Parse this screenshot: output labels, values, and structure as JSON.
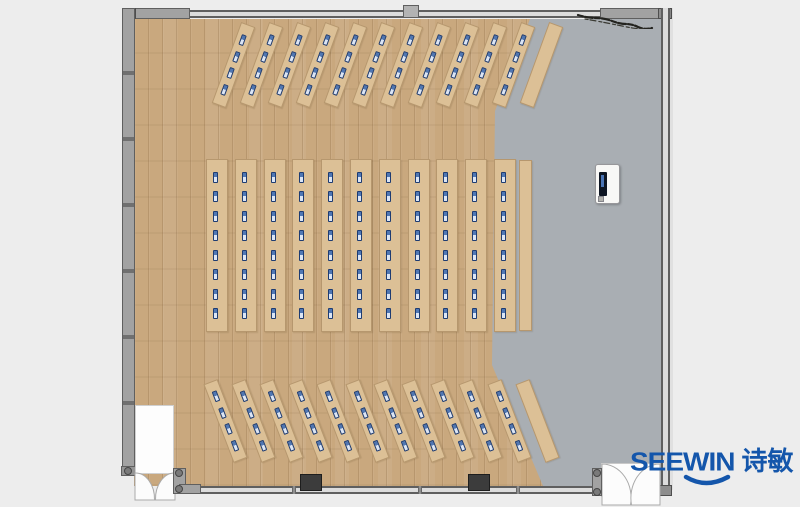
{
  "branding": {
    "logo_text": "SEEWIN",
    "logo_cjk": "诗敏"
  },
  "palette": {
    "page_bg": "#ededed",
    "wood_floor": "#c9a87e",
    "gray_floor": "#a9aeb3",
    "wall_fill": "#a2a2a2",
    "wall_dark": "#5f5f5f",
    "wall_light": "#dcdcdc",
    "desk_fill": "#dcc096",
    "monitor_navy": "#1e3c72",
    "monitor_light": "#dbe5f5",
    "pillar_dark": "#3c3c3c",
    "brand_blue": "#1456ab"
  },
  "floorplan": {
    "description": "Training room / lecture hall plan: fan arrangement of long desks with monitors on wood floor, open gray floor presentation area on right with podium",
    "desk_sections": [
      {
        "name": "top-angled-rows",
        "count": 12,
        "monitors_per_desk": 4,
        "plain_last": true,
        "angle_deg": 20,
        "desk_length": 86,
        "desk_width": 15,
        "start_x": 248,
        "step_x": 28,
        "top_y": 25,
        "monitor_offset": 4
      },
      {
        "name": "middle-columns",
        "count": 11,
        "monitors_per_desk": 8,
        "plain_last": false,
        "angle_deg": 0,
        "desk_length": 173,
        "desk_width": 22,
        "start_x": 217,
        "step_x": 28.8,
        "top_y": 159,
        "monitor_offset": 6
      },
      {
        "name": "bottom-angled-rows",
        "count": 12,
        "monitors_per_desk": 4,
        "plain_last": true,
        "angle_deg": -21,
        "desk_length": 84,
        "desk_width": 15,
        "start_x": 210,
        "step_x": 28.4,
        "top_y": 382,
        "monitor_offset": 4
      }
    ],
    "side_counter": {
      "x": 519,
      "y": 160,
      "width": 13,
      "height": 171
    },
    "podium": {
      "x": 595,
      "y": 164,
      "width": 25,
      "height": 40
    }
  }
}
